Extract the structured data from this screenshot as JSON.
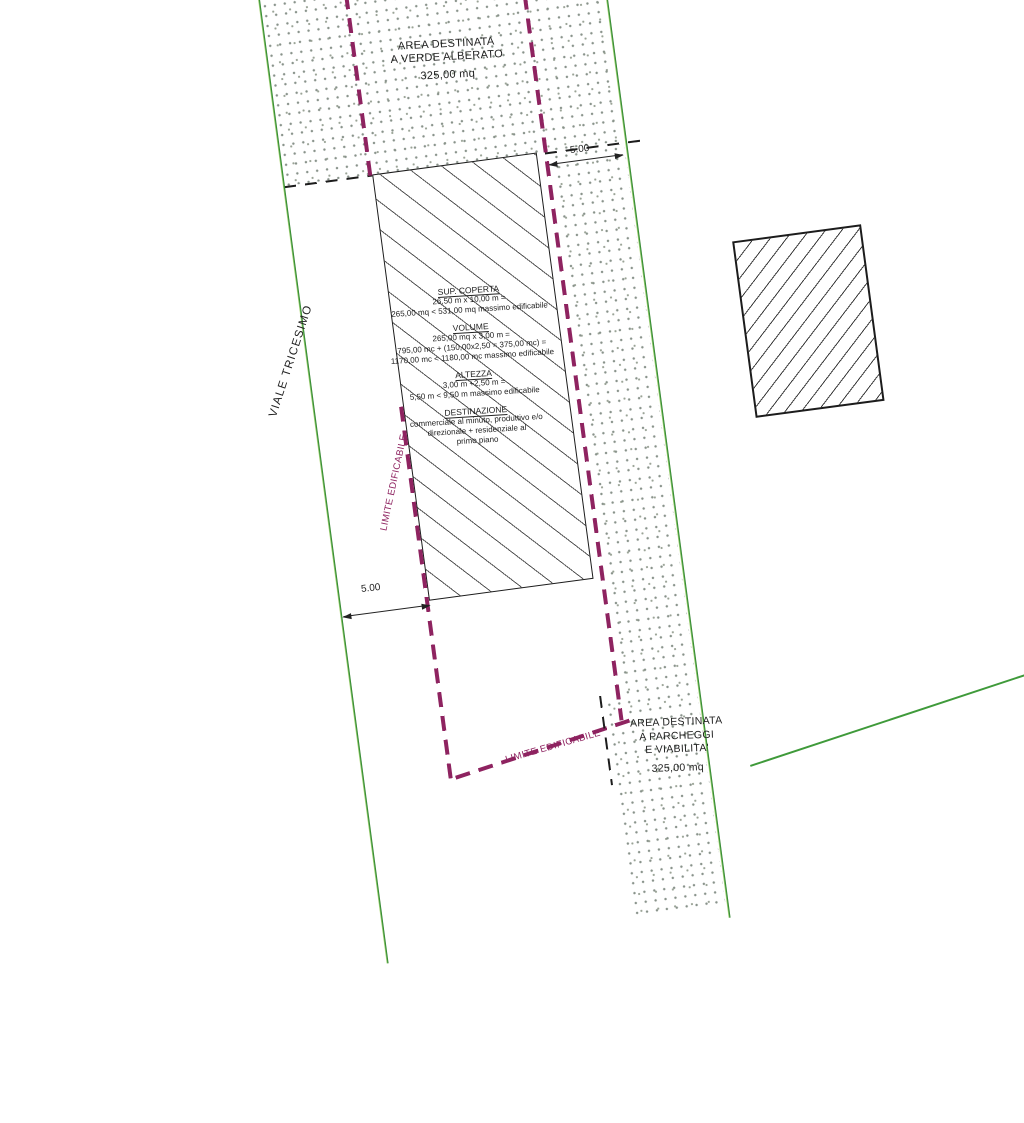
{
  "plan": {
    "verde_area": {
      "line1": "AREA DESTINATA",
      "line2": "A VERDE ALBERATO",
      "area": "325,00 mq"
    },
    "street": {
      "name": "VIALE TRICESIMO"
    },
    "buildable_specs": {
      "sections": [
        {
          "title": "SUP. COPERTA",
          "lines": [
            "26,50 m x 10,00 m =",
            "265,00 mq < 531,00 mq massimo edificabile"
          ]
        },
        {
          "title": "VOLUME",
          "lines": [
            "265,00 mq x 3,00 m =",
            "795,00 mc + (150,00x2,50 = 375,00 mc) =",
            "1170,00 mc < 1180,00 mc massimo edificabile"
          ]
        },
        {
          "title": "ALTEZZA",
          "lines": [
            "3,00 m +2,50 m =",
            "5,50 m < 9,50 m massimo edificabile"
          ]
        },
        {
          "title": "DESTINAZIONE",
          "lines": [
            "commerciale al minuto, produttivo e/o",
            "direzionale + residenziale al",
            "primo piano"
          ]
        }
      ]
    },
    "limite_label_left": "LIMITE EDIFICABILE",
    "limite_label_bottom": "LIMITE EDIFICABILE",
    "parcheggi_area": {
      "line1": "AREA DESTINATA",
      "line2": "A PARCHEGGI",
      "line3": "E VIABILITA'",
      "area": "325,00 mq"
    },
    "dimensions": {
      "top": "5.00",
      "left": "5.00"
    },
    "colors": {
      "limite_purple": "#8e2360",
      "boundary_green": "#3f9a3a",
      "line_black": "#1c1c1c",
      "stipple_dot": "#88928a",
      "hatch_gray": "#565656"
    }
  }
}
